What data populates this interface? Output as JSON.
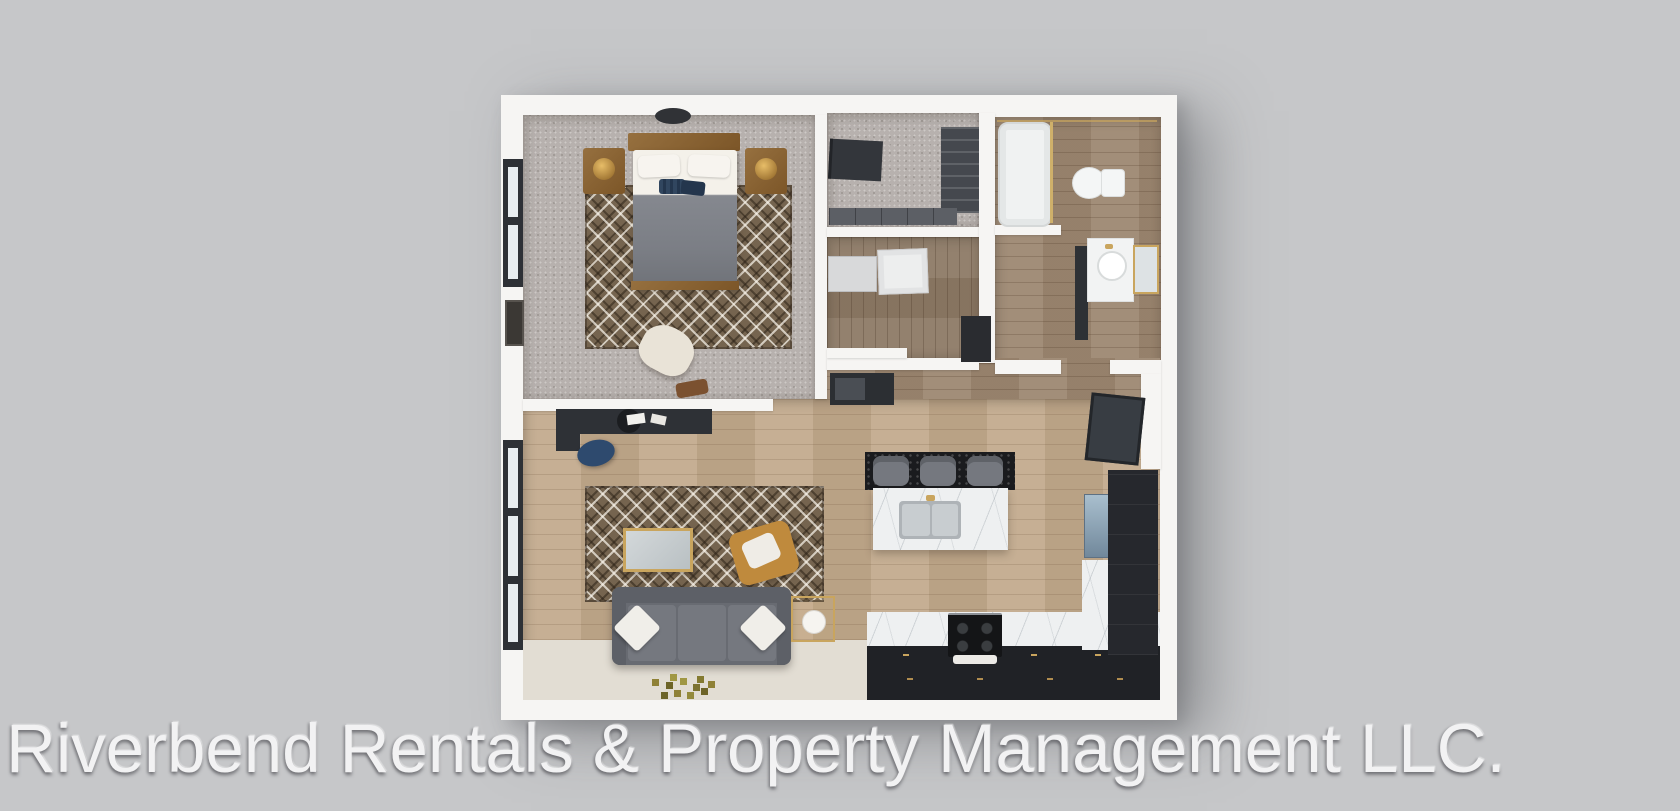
{
  "watermark": {
    "text": "Riverbend Rentals & Property Management LLC."
  },
  "image": {
    "kind": "3D rendered apartment floor plan, top-down view",
    "layout": "one-bedroom apartment with walk-in closet, laundry, bathroom, open living room and kitchen"
  },
  "palette": {
    "background": "#c6c7c9",
    "walls": "#f6f5f3",
    "carpet": "#b7b1ae",
    "wood_light": "#c2aa8d",
    "wood_dark": "#9d8872",
    "cream_floor": "#e2ddd3",
    "cabinet_dark": "#26282d",
    "charcoal": "#33363b",
    "marble": "#eef0f1",
    "gold_accent": "#c9a55e",
    "sofa_gray": "#686b72",
    "navy_accent": "#2e4a6e",
    "fridge_blue": "#8fa5b7"
  },
  "rooms": [
    {
      "name": "bedroom",
      "items": [
        "ceiling-light",
        "window",
        "headboard",
        "bed",
        "pillows",
        "accent-pillows",
        "nightstand-left",
        "nightstand-right",
        "table-lamps",
        "area-rug",
        "accent-chair",
        "wall-art",
        "bag"
      ]
    },
    {
      "name": "walk-in-closet",
      "items": [
        "wardrobe",
        "shelving-unit",
        "low-cabinets"
      ]
    },
    {
      "name": "laundry",
      "items": [
        "washer",
        "dryer",
        "utility-cabinet"
      ]
    },
    {
      "name": "bathroom",
      "items": [
        "bathtub",
        "glass-panel",
        "toilet",
        "vanity",
        "sink-basin",
        "gold-mirror",
        "storage-cabinet"
      ]
    },
    {
      "name": "hallway",
      "items": [
        "closet-nook",
        "leaning-mirror"
      ]
    },
    {
      "name": "living-room",
      "items": [
        "desk",
        "desk-chair",
        "papers",
        "office-chair",
        "area-rug",
        "coffee-table",
        "accent-chair",
        "sofa",
        "throw-pillows",
        "side-table",
        "lamp",
        "floor-mosaic",
        "window"
      ]
    },
    {
      "name": "kitchen",
      "items": [
        "bar-mat",
        "bar-stools",
        "island",
        "double-sink",
        "faucet",
        "counter-run",
        "cabinet-handles",
        "range-stove",
        "oven-towel",
        "corner-counter",
        "refrigerator",
        "tall-cabinets"
      ]
    }
  ]
}
